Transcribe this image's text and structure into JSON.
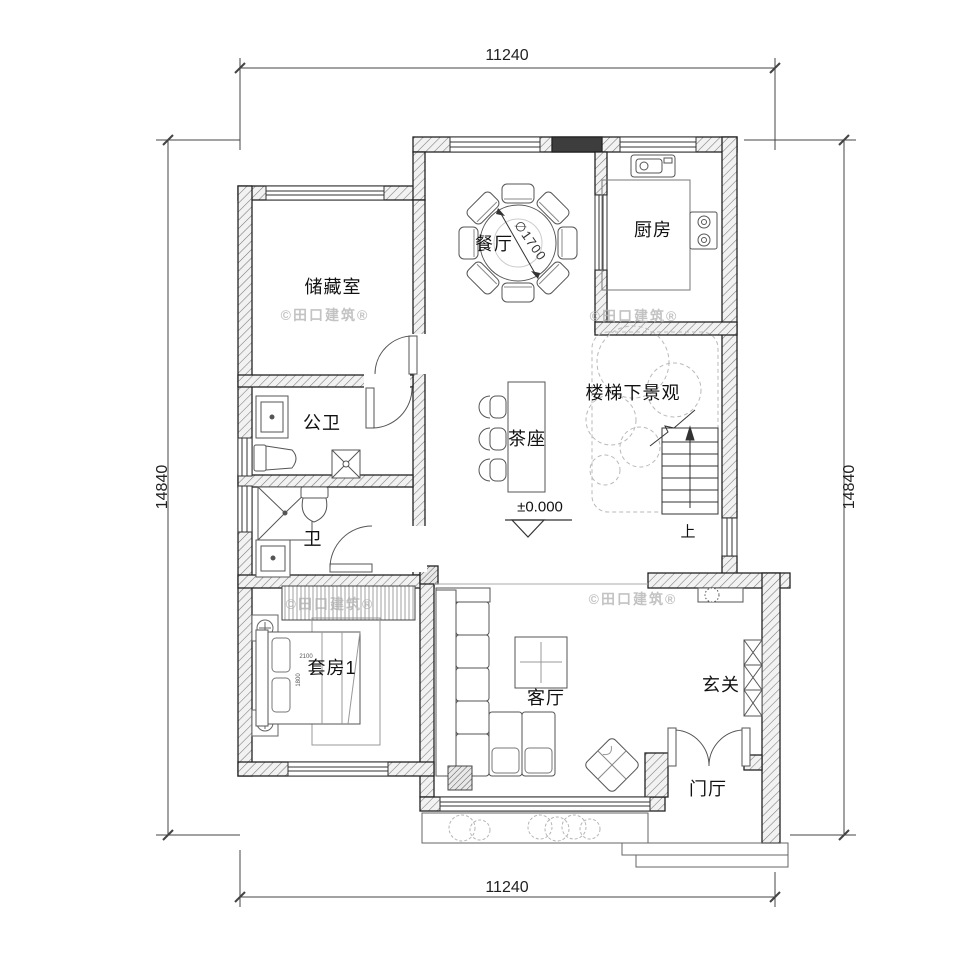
{
  "dimensions": {
    "top": "11240",
    "bottom": "11240",
    "left": "14840",
    "right": "14840"
  },
  "rooms": {
    "dining": "餐厅",
    "kitchen": "厨房",
    "storage": "储藏室",
    "public_bath": "公卫",
    "bath": "卫",
    "tea_seat": "茶座",
    "under_stair_view": "楼梯下景观",
    "suite1": "套房1",
    "living": "客厅",
    "entrance": "玄关",
    "foyer": "门厅"
  },
  "annotations": {
    "stairs_up": "上",
    "level": "±0.000",
    "table_diameter": "∅1700",
    "bed_width": "2100",
    "bed_depth": "1800"
  },
  "watermark": "©田口建筑®",
  "colors": {
    "line": "#2a2a2a",
    "wall_stroke": "#222222",
    "hatch": "#666666",
    "light": "#bbbbbb",
    "watermark": "#c4c4c4"
  }
}
